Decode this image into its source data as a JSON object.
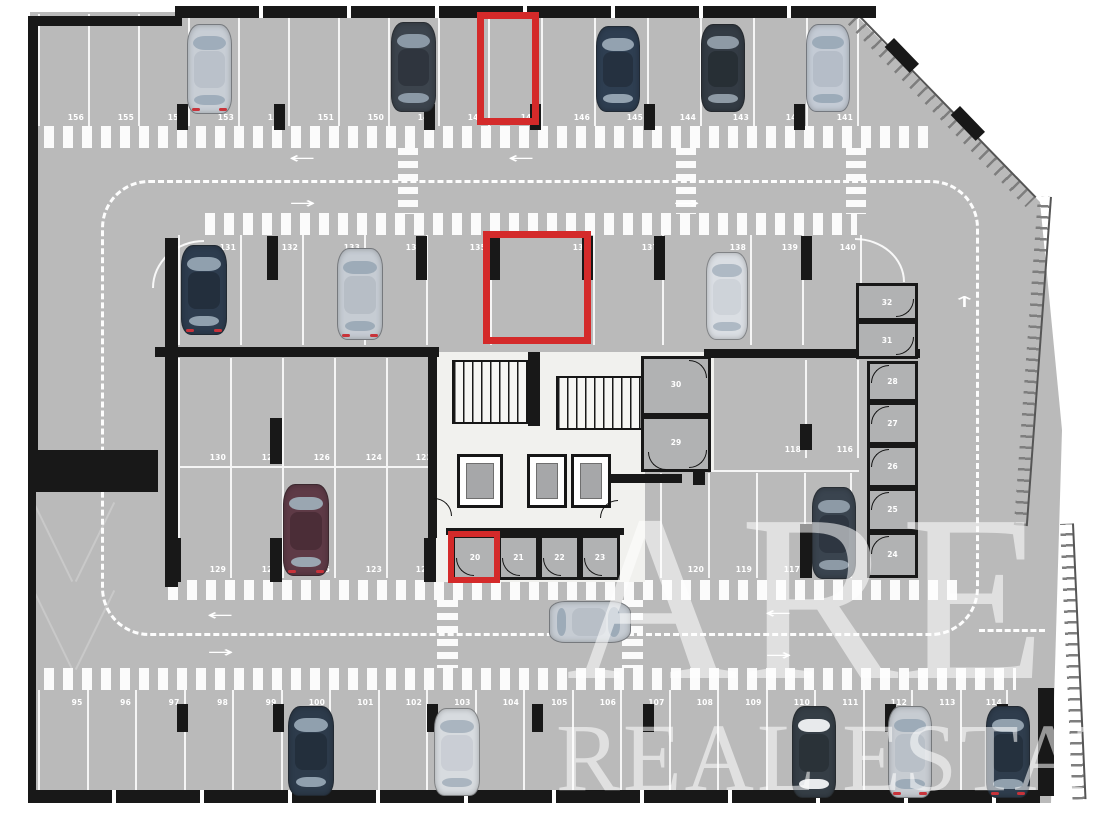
{
  "watermark": {
    "line1": "ARE",
    "line2": "REAL ESTATE"
  },
  "palette": {
    "floor": "#bababa",
    "wall": "#181818",
    "marking": "#ffffff",
    "highlight": "#d42a2a",
    "room": "#b1b2b3",
    "core": "#f1f1ee"
  },
  "highlighted_spots": [
    "147",
    "136",
    "20"
  ],
  "parking_rows": [
    {
      "id": "top-row",
      "x": 38,
      "y": 14,
      "h": 112,
      "label_side": "bottom",
      "widths": [
        50,
        50,
        50,
        50,
        50,
        50,
        50,
        50,
        50,
        53,
        53,
        53,
        53,
        53,
        53,
        53
      ],
      "labels": [
        "156",
        "155",
        "154",
        "153",
        "152",
        "151",
        "150",
        "149",
        "148",
        "147",
        "146",
        "145",
        "144",
        "143",
        "142",
        "141"
      ]
    },
    {
      "id": "second-row",
      "x": 178,
      "y": 235,
      "h": 110,
      "label_side": "top",
      "widths": [
        62,
        62,
        62,
        62,
        64,
        103,
        69,
        88,
        52,
        60
      ],
      "labels": [
        "131",
        "132",
        "133",
        "134",
        "135",
        "136",
        "137",
        "138",
        "139",
        "140"
      ]
    },
    {
      "id": "left-block-upper",
      "x": 178,
      "y": 358,
      "h": 108,
      "label_side": "bottom",
      "widths": [
        52,
        52,
        52,
        52,
        52
      ],
      "labels": [
        "130",
        "128",
        "126",
        "124",
        "122"
      ]
    },
    {
      "id": "left-block-lower",
      "x": 178,
      "y": 468,
      "h": 110,
      "label_side": "bottom",
      "widths": [
        52,
        52,
        52,
        52,
        52
      ],
      "labels": [
        "129",
        "127",
        "125",
        "123",
        "121"
      ]
    },
    {
      "id": "right-block-upper",
      "x": 697,
      "y": 360,
      "h": 98,
      "label_side": "bottom",
      "widths": [
        108,
        54
      ],
      "labels": [
        "118",
        "116"
      ]
    },
    {
      "id": "right-block-lower",
      "x": 660,
      "y": 473,
      "h": 105,
      "label_side": "bottom",
      "widths": [
        48,
        48,
        48,
        48
      ],
      "labels": [
        "120",
        "119",
        "117",
        "115"
      ]
    },
    {
      "id": "bottom-row",
      "x": 38,
      "y": 690,
      "h": 108,
      "label_side": "top",
      "widths": [
        48.5,
        48.5,
        48.5,
        48.5,
        48.5,
        48.5,
        48.5,
        48.5,
        48.5,
        48.5,
        48.5,
        48.5,
        48.5,
        48.5,
        48.5,
        48.5,
        48.5,
        48.5,
        48.5,
        48.5
      ],
      "labels": [
        "95",
        "96",
        "97",
        "98",
        "99",
        "100",
        "101",
        "102",
        "103",
        "104",
        "105",
        "106",
        "107",
        "108",
        "109",
        "110",
        "111",
        "112",
        "113",
        "114"
      ]
    }
  ],
  "storage_rooms": [
    {
      "n": "32",
      "x": 856,
      "y": 283,
      "w": 62,
      "h": 38,
      "door": "br"
    },
    {
      "n": "31",
      "x": 856,
      "y": 321,
      "w": 62,
      "h": 38,
      "door": "br"
    },
    {
      "n": "30",
      "x": 641,
      "y": 356,
      "w": 70,
      "h": 60,
      "door": "tr"
    },
    {
      "n": "29",
      "x": 641,
      "y": 416,
      "w": 70,
      "h": 56,
      "door": "br"
    },
    {
      "n": "28",
      "x": 867,
      "y": 361,
      "w": 51,
      "h": 41,
      "door": "tl"
    },
    {
      "n": "27",
      "x": 867,
      "y": 402,
      "w": 51,
      "h": 43,
      "door": "tl"
    },
    {
      "n": "26",
      "x": 867,
      "y": 445,
      "w": 51,
      "h": 43,
      "door": "tl"
    },
    {
      "n": "25",
      "x": 867,
      "y": 488,
      "w": 51,
      "h": 44,
      "door": "tl"
    },
    {
      "n": "24",
      "x": 867,
      "y": 532,
      "w": 51,
      "h": 46,
      "door": "tl"
    },
    {
      "n": "20",
      "x": 452,
      "y": 535,
      "w": 46,
      "h": 45,
      "door": "bl"
    },
    {
      "n": "21",
      "x": 498,
      "y": 535,
      "w": 41,
      "h": 45,
      "door": "bl"
    },
    {
      "n": "22",
      "x": 539,
      "y": 535,
      "w": 41,
      "h": 45,
      "door": "bl"
    },
    {
      "n": "23",
      "x": 580,
      "y": 535,
      "w": 40,
      "h": 45,
      "door": "bl"
    }
  ],
  "highlight_boxes": [
    {
      "spot": "147",
      "x": 477,
      "y": 12,
      "w": 62,
      "h": 113,
      "bw": 7
    },
    {
      "spot": "136",
      "x": 483,
      "y": 231,
      "w": 108,
      "h": 113,
      "bw": 7
    },
    {
      "spot": "20",
      "x": 448,
      "y": 531,
      "w": 52,
      "h": 52,
      "bw": 6
    }
  ],
  "cars": [
    {
      "x": 187,
      "y": 24,
      "w": 45,
      "h": 90,
      "body": "#c8ced5",
      "roof": "#b9c0c9",
      "glass": "#9fadbb",
      "tail": true
    },
    {
      "x": 391,
      "y": 22,
      "w": 45,
      "h": 90,
      "body": "#3c444d",
      "roof": "#2e353d",
      "glass": "#8b99a6",
      "tail": false
    },
    {
      "x": 596,
      "y": 26,
      "w": 44,
      "h": 86,
      "body": "#2e3e51",
      "roof": "#25303f",
      "glass": "#93a2b0",
      "tail": false
    },
    {
      "x": 701,
      "y": 24,
      "w": 44,
      "h": 88,
      "body": "#333b44",
      "roof": "#272e35",
      "glass": "#8e9aa5",
      "tail": false
    },
    {
      "x": 806,
      "y": 24,
      "w": 44,
      "h": 88,
      "body": "#c4cbd5",
      "roof": "#b4bcc7",
      "glass": "#9cabb9",
      "tail": false
    },
    {
      "x": 181,
      "y": 245,
      "w": 46,
      "h": 90,
      "body": "#2d3c4e",
      "roof": "#232e3c",
      "glass": "#90a0ae",
      "tail": true
    },
    {
      "x": 337,
      "y": 248,
      "w": 46,
      "h": 92,
      "body": "#c6ccd3",
      "roof": "#b6bdc5",
      "glass": "#9dabb8",
      "tail": true
    },
    {
      "x": 706,
      "y": 252,
      "w": 42,
      "h": 88,
      "body": "#dadee3",
      "roof": "#cdd2d8",
      "glass": "#aeb9c4",
      "tail": false
    },
    {
      "x": 283,
      "y": 484,
      "w": 46,
      "h": 92,
      "body": "#5e3a46",
      "roof": "#4a2c37",
      "glass": "#9aa6b1",
      "tail": true
    },
    {
      "x": 812,
      "y": 487,
      "w": 44,
      "h": 92,
      "body": "#3a444f",
      "roof": "#2d3640",
      "glass": "#8d9aa6",
      "tail": false
    },
    {
      "x": 288,
      "y": 706,
      "w": 46,
      "h": 90,
      "body": "#2d3b4b",
      "roof": "#232e3b",
      "glass": "#90a0ae",
      "tail": false
    },
    {
      "x": 434,
      "y": 708,
      "w": 46,
      "h": 88,
      "body": "#d7dbdf",
      "roof": "#c9ced4",
      "glass": "#aab5c0",
      "tail": false
    },
    {
      "x": 792,
      "y": 706,
      "w": 44,
      "h": 92,
      "body": "#353e46",
      "roof": "#2a3138",
      "glass": "#e8eaec",
      "tail": false
    },
    {
      "x": 888,
      "y": 706,
      "w": 44,
      "h": 92,
      "body": "#c7ccd2",
      "roof": "#b8bfc7",
      "glass": "#9dabb8",
      "tail": true
    },
    {
      "x": 986,
      "y": 706,
      "w": 44,
      "h": 92,
      "body": "#2f3d4d",
      "roof": "#25303d",
      "glass": "#91a0ad",
      "tail": true
    },
    {
      "x": 569,
      "y": 581,
      "w": 42,
      "h": 82,
      "rot": 90,
      "body": "#c6ccd3",
      "roof": "#b7bec6",
      "glass": "#9dabb8",
      "tail": false
    }
  ],
  "walls": [
    {
      "x": 28,
      "y": 16,
      "w": 154,
      "h": 10
    },
    {
      "x": 175,
      "y": 6,
      "w": 684,
      "h": 12,
      "slits": true
    },
    {
      "x": 852,
      "y": 6,
      "w": 24,
      "h": 12
    },
    {
      "x": 28,
      "y": 16,
      "w": 10,
      "h": 436
    },
    {
      "x": 28,
      "y": 450,
      "w": 130,
      "h": 42
    },
    {
      "x": 28,
      "y": 490,
      "w": 8,
      "h": 305
    },
    {
      "x": 28,
      "y": 790,
      "w": 1012,
      "h": 13,
      "slits": true
    },
    {
      "x": 155,
      "y": 347,
      "w": 284,
      "h": 10
    },
    {
      "x": 704,
      "y": 349,
      "w": 216,
      "h": 9
    },
    {
      "x": 165,
      "y": 238,
      "w": 13,
      "h": 110
    },
    {
      "x": 165,
      "y": 347,
      "w": 13,
      "h": 240
    },
    {
      "x": 1038,
      "y": 688,
      "w": 16,
      "h": 108
    },
    {
      "x": 894,
      "y": 38,
      "w": 36,
      "h": 13,
      "rot": 46
    },
    {
      "x": 960,
      "y": 106,
      "w": 36,
      "h": 13,
      "rot": 46
    }
  ],
  "columns": [
    {
      "x": 177,
      "y": 104,
      "w": 11,
      "h": 26
    },
    {
      "x": 274,
      "y": 104,
      "w": 11,
      "h": 26
    },
    {
      "x": 424,
      "y": 104,
      "w": 11,
      "h": 26
    },
    {
      "x": 530,
      "y": 104,
      "w": 11,
      "h": 26
    },
    {
      "x": 644,
      "y": 104,
      "w": 11,
      "h": 26
    },
    {
      "x": 794,
      "y": 104,
      "w": 11,
      "h": 26
    },
    {
      "x": 267,
      "y": 236,
      "w": 11,
      "h": 44
    },
    {
      "x": 416,
      "y": 236,
      "w": 11,
      "h": 44
    },
    {
      "x": 489,
      "y": 236,
      "w": 11,
      "h": 44
    },
    {
      "x": 582,
      "y": 236,
      "w": 11,
      "h": 44
    },
    {
      "x": 654,
      "y": 236,
      "w": 11,
      "h": 44
    },
    {
      "x": 801,
      "y": 236,
      "w": 11,
      "h": 44
    },
    {
      "x": 800,
      "y": 424,
      "w": 12,
      "h": 26
    },
    {
      "x": 270,
      "y": 418,
      "w": 12,
      "h": 46
    },
    {
      "x": 168,
      "y": 538,
      "w": 13,
      "h": 44
    },
    {
      "x": 270,
      "y": 538,
      "w": 12,
      "h": 44
    },
    {
      "x": 424,
      "y": 538,
      "w": 12,
      "h": 44
    },
    {
      "x": 693,
      "y": 443,
      "w": 12,
      "h": 42
    },
    {
      "x": 800,
      "y": 524,
      "w": 12,
      "h": 54
    },
    {
      "x": 177,
      "y": 704,
      "w": 11,
      "h": 28
    },
    {
      "x": 273,
      "y": 704,
      "w": 11,
      "h": 28
    },
    {
      "x": 427,
      "y": 704,
      "w": 11,
      "h": 28
    },
    {
      "x": 532,
      "y": 704,
      "w": 11,
      "h": 28
    },
    {
      "x": 643,
      "y": 704,
      "w": 11,
      "h": 28
    },
    {
      "x": 885,
      "y": 704,
      "w": 11,
      "h": 28
    },
    {
      "x": 997,
      "y": 704,
      "w": 11,
      "h": 28
    }
  ],
  "crosswalk_bands": [
    {
      "x": 44,
      "y": 126,
      "w": 890,
      "h": 22
    },
    {
      "x": 205,
      "y": 213,
      "w": 652,
      "h": 22
    },
    {
      "x": 168,
      "y": 580,
      "w": 790,
      "h": 20
    },
    {
      "x": 44,
      "y": 668,
      "w": 972,
      "h": 22
    }
  ],
  "crosswalk_columns": [
    {
      "x": 398,
      "y": 148,
      "w": 20,
      "h": 66
    },
    {
      "x": 676,
      "y": 148,
      "w": 20,
      "h": 66
    },
    {
      "x": 846,
      "y": 148,
      "w": 20,
      "h": 66
    },
    {
      "x": 437,
      "y": 600,
      "w": 21,
      "h": 68
    },
    {
      "x": 622,
      "y": 600,
      "w": 21,
      "h": 68
    }
  ],
  "divider_lines": [
    {
      "x": 178,
      "y": 466,
      "w": 260,
      "h": 2
    },
    {
      "x": 697,
      "y": 470,
      "w": 162,
      "h": 2
    }
  ],
  "lane_arrows": [
    {
      "x": 296,
      "y": 151,
      "g": "←"
    },
    {
      "x": 515,
      "y": 151,
      "g": "←"
    },
    {
      "x": 296,
      "y": 196,
      "g": "→"
    },
    {
      "x": 680,
      "y": 196,
      "g": "→"
    },
    {
      "x": 214,
      "y": 608,
      "g": "←"
    },
    {
      "x": 214,
      "y": 645,
      "g": "→"
    },
    {
      "x": 772,
      "y": 606,
      "g": "←"
    },
    {
      "x": 772,
      "y": 648,
      "g": "→"
    },
    {
      "x": 958,
      "y": 295,
      "g": "↑"
    }
  ]
}
